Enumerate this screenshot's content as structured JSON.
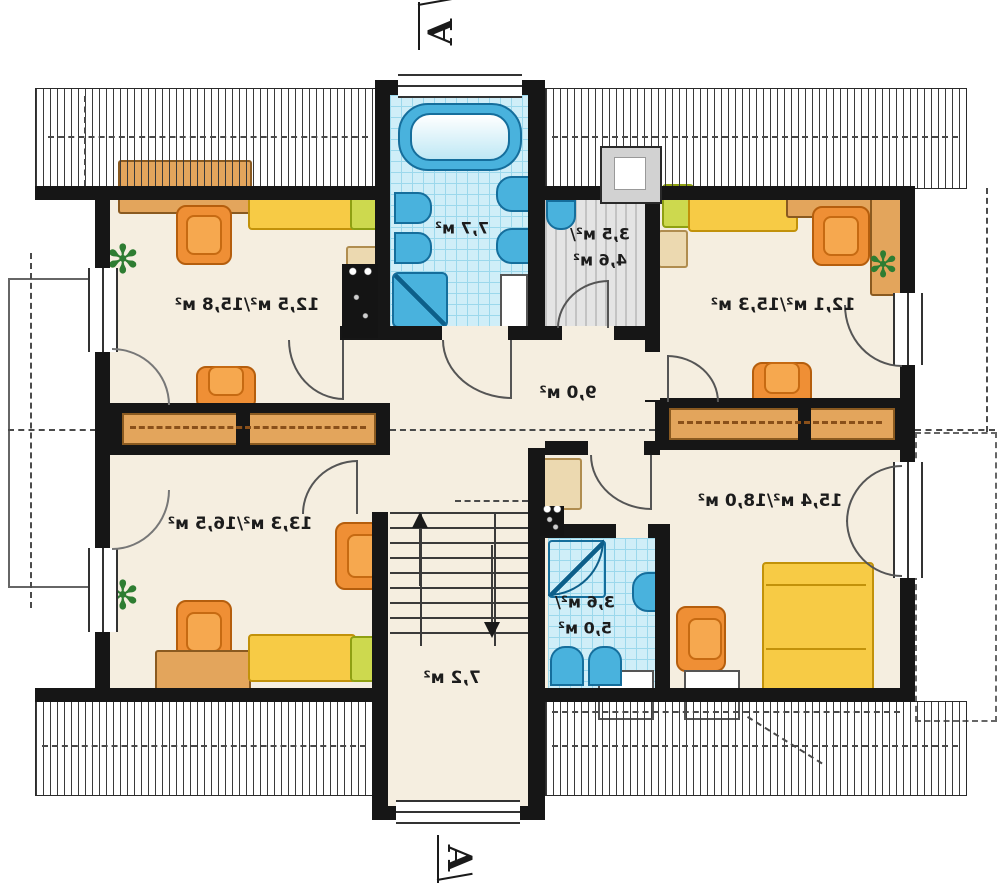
{
  "plan_title": "attic floor plan (mirrored)",
  "section": {
    "top": "A",
    "bottom": "A"
  },
  "rooms": {
    "bedroom_top_left": {
      "area": "12,5 м²/15,8 м²"
    },
    "bathroom_top": {
      "area": "7,7 м²"
    },
    "wardrobe": {
      "area_line1": "3,5 м²/",
      "area_line2": "4,6 м²"
    },
    "bedroom_top_right": {
      "area": "12,1 м²/15,3 м²"
    },
    "hall": {
      "area": "9,0 м²"
    },
    "bedroom_bottom_left": {
      "area": "13,3 м²/16,5 м²"
    },
    "bedroom_bottom_right": {
      "area": "15,4 м²/18,0 м²"
    },
    "bathroom_bottom": {
      "area_line1": "3,6 м²/",
      "area_line2": "5,0 м²"
    },
    "staircase": {
      "area": "7,2 м²"
    }
  },
  "colors": {
    "wall": "#161616",
    "floor_cream": "#f5eee0",
    "tile_blue": "#cfeef8",
    "fixture_blue": "#49b2dd",
    "furniture_orange": "#ef8f35",
    "furniture_yellow": "#f7cb45",
    "furniture_green": "#cdd94e",
    "wood_brown": "#e3a55c"
  }
}
